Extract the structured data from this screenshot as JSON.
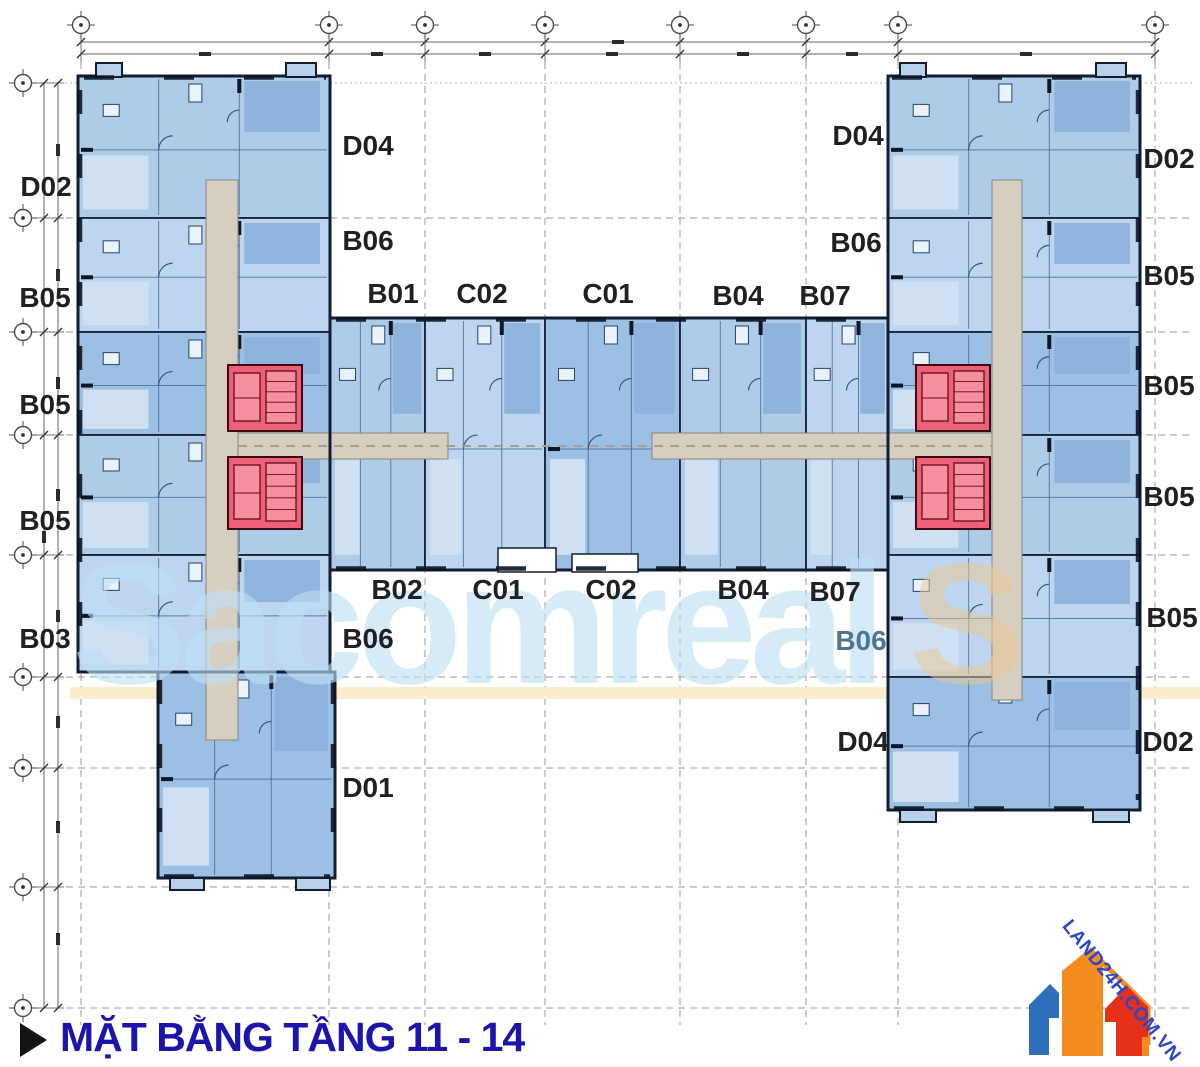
{
  "title": {
    "marker_icon": "play-triangle-icon",
    "text": "MẶT BẰNG TẦNG 11 - 14",
    "color": "#1b15ae"
  },
  "watermark": {
    "text": "Sacomreal",
    "suffix": "S"
  },
  "logo": {
    "text": "LAND24H.COM.VN",
    "colors": {
      "blue": "#2d6fba",
      "orange": "#f28c1e",
      "red": "#e63119",
      "text": "#2b45cc"
    }
  },
  "plan": {
    "colors": {
      "unit_fill": "#aecbe8",
      "unit_dark": "#8cb2db",
      "unit_light": "#cfe0f2",
      "wall": "#121d33",
      "core_red": "#ef6078",
      "corridor": "#d6cfc1",
      "highlight_band_yellow": "#faeeca"
    },
    "units": [
      {
        "label": "D02"
      },
      {
        "label": "B05"
      },
      {
        "label": "B05"
      },
      {
        "label": "B05"
      },
      {
        "label": "B03"
      },
      {
        "label": "D04"
      },
      {
        "label": "B06"
      },
      {
        "label": "B01"
      },
      {
        "label": "C02"
      },
      {
        "label": "C01"
      },
      {
        "label": "B04"
      },
      {
        "label": "B07"
      },
      {
        "label": "D04"
      },
      {
        "label": "B06"
      },
      {
        "label": "D02"
      },
      {
        "label": "B05"
      },
      {
        "label": "B05"
      },
      {
        "label": "B05"
      },
      {
        "label": "B05"
      },
      {
        "label": "D02"
      },
      {
        "label": "B02"
      },
      {
        "label": "C01"
      },
      {
        "label": "C02"
      },
      {
        "label": "B04"
      },
      {
        "label": "B07"
      },
      {
        "label": "B06"
      },
      {
        "label": "B06"
      },
      {
        "label": "D01"
      },
      {
        "label": "D04"
      }
    ]
  }
}
